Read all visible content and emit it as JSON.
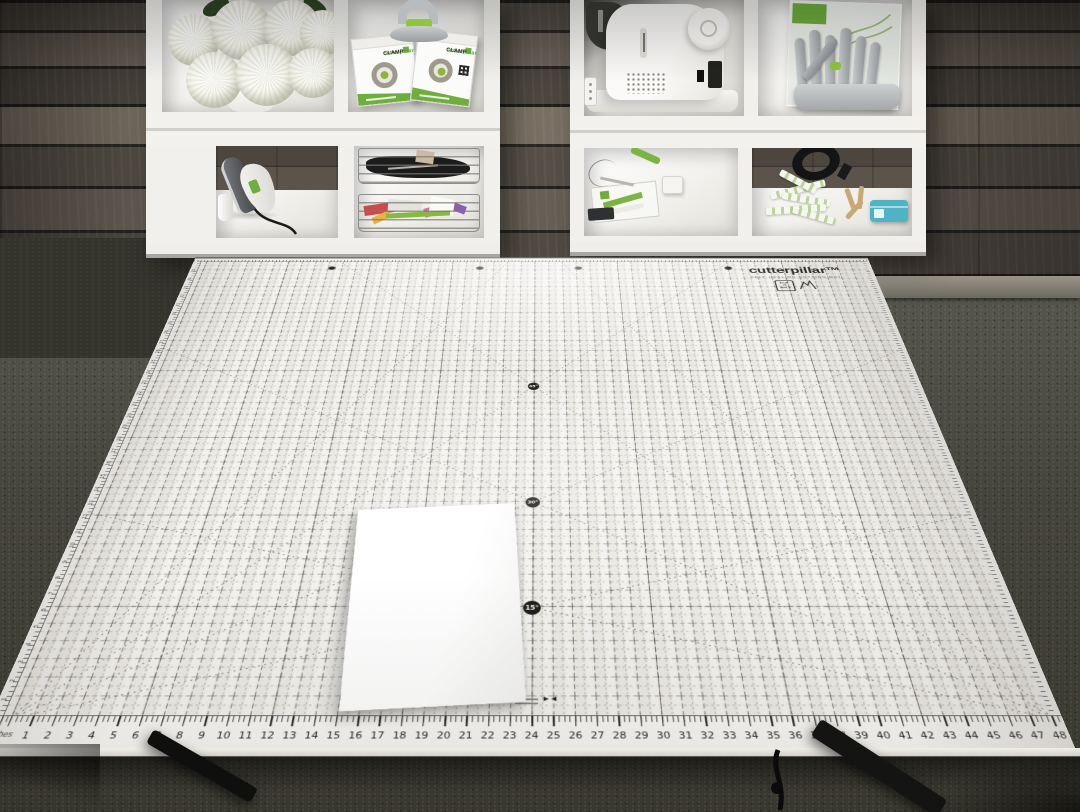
{
  "mat": {
    "brand": "cutterpillar™",
    "tagline": "SELF-HEALING CUTTING MAT",
    "flip_box_lines": [
      "FLIP",
      "IT",
      "WALK"
    ],
    "inches_label": "inches",
    "bottom_ruler": [
      1,
      2,
      3,
      4,
      5,
      6,
      7,
      8,
      9,
      10,
      11,
      12,
      13,
      14,
      15,
      16,
      17,
      18,
      19,
      20,
      21,
      22,
      23,
      24,
      25,
      26,
      27,
      28,
      29,
      30,
      31,
      32,
      33,
      34,
      35,
      36,
      37,
      38,
      39,
      40,
      41,
      42,
      43,
      44,
      45,
      46,
      47,
      48
    ],
    "left_ruler": [
      1,
      2,
      3,
      4,
      5,
      6,
      7,
      8,
      9,
      10,
      11,
      12,
      13,
      14,
      15,
      16,
      17,
      18,
      19,
      20,
      21,
      22,
      23,
      24,
      25,
      26,
      27,
      28,
      29,
      30,
      31,
      32,
      33,
      34,
      35
    ],
    "angle_markers": [
      "45°",
      "30°",
      "15°"
    ],
    "center_mark_arrows": "►◄"
  },
  "shelves": {
    "clamp_box": {
      "brand": "cutterpillar",
      "product": "CLAMP"
    }
  },
  "colors": {
    "accent_green": "#6fae3e",
    "bright_green": "#8fc53f",
    "teal_box": "#4fb3c4",
    "mat_surface": "#eceae5",
    "grid_line": "#35332f"
  }
}
